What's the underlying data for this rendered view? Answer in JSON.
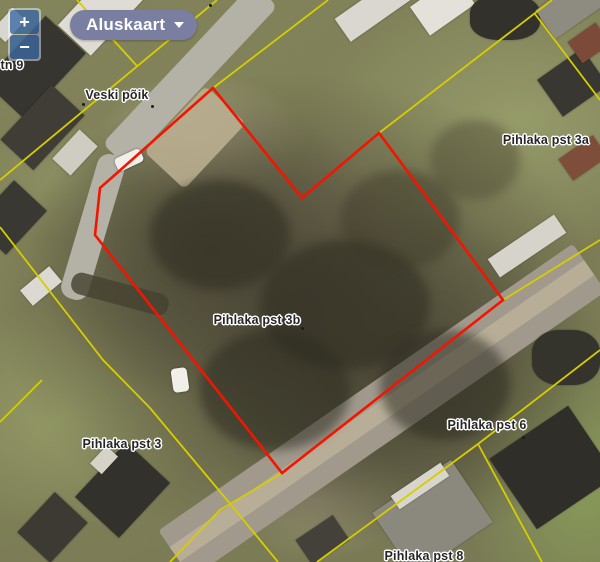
{
  "controls": {
    "zoom_in_label": "+",
    "zoom_out_label": "−",
    "basemap_button_label": "Aluskaart"
  },
  "map": {
    "selected_parcel_label": "Pihlaka pst 3b",
    "labels": [
      {
        "text": "ki tn 9"
      },
      {
        "text": "Veski põik"
      },
      {
        "text": "Pihlaka pst 3a"
      },
      {
        "text": "Pihlaka pst 3b"
      },
      {
        "text": "Pihlaka pst 3"
      },
      {
        "text": "Pihlaka pst 6"
      },
      {
        "text": "Pihlaka pst 8"
      }
    ],
    "colors": {
      "selected_parcel_outline": "#f21500",
      "cadastral_boundary": "#d6cd00",
      "basemap_button_bg": "#7a7ea1",
      "zoom_button_bg": "rgba(0,60,136,0.6)",
      "label_text": "#262626"
    }
  }
}
